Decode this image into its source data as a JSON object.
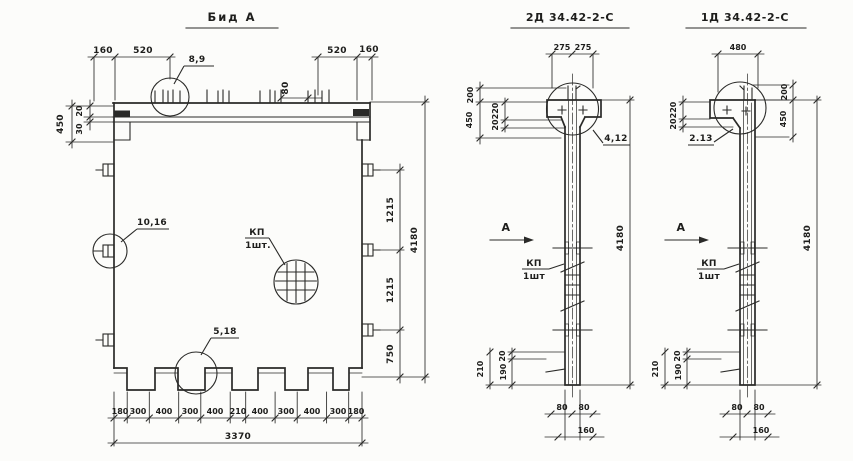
{
  "main": {
    "title": "Бид А",
    "top_left": [
      "160",
      "520"
    ],
    "top_right": [
      "520",
      "160"
    ],
    "detail_top": "8,9",
    "tooth_gap": "80",
    "left": {
      "overall": "450",
      "a": "20",
      "b": "30"
    },
    "right": {
      "seg": [
        "1215",
        "1215",
        "750"
      ],
      "overall": "4180"
    },
    "bottom": [
      "180",
      "300",
      "400",
      "300",
      "400",
      "210",
      "400",
      "300",
      "400",
      "300",
      "180"
    ],
    "bottom_total": "3370",
    "detail_left": "10,16",
    "detail_bottom": "5,18",
    "kp": "КП",
    "kp_qty": "1шт."
  },
  "s2": {
    "title": "2Д 34.42-2-С",
    "top": [
      "275",
      "275"
    ],
    "outer": [
      "200",
      "450"
    ],
    "inner": [
      "220",
      "20"
    ],
    "detail": "4,12",
    "height": "4180",
    "section_mark": "А",
    "kp": "КП",
    "kp_qty": "1шт",
    "foot": {
      "overall": "210",
      "a": "20",
      "b": "190"
    },
    "widths": [
      "80",
      "80"
    ],
    "width_total": "160"
  },
  "s1": {
    "title": "1Д 34.42-2-С",
    "top": "480",
    "outer": [
      "200",
      "450"
    ],
    "inner": [
      "220",
      "20"
    ],
    "detail": "2.13",
    "height": "4180",
    "section_mark": "А",
    "kp": "КП",
    "kp_qty": "1шт",
    "foot": {
      "overall": "210",
      "a": "20",
      "b": "190"
    },
    "widths": [
      "80",
      "80"
    ],
    "width_total": "160"
  }
}
